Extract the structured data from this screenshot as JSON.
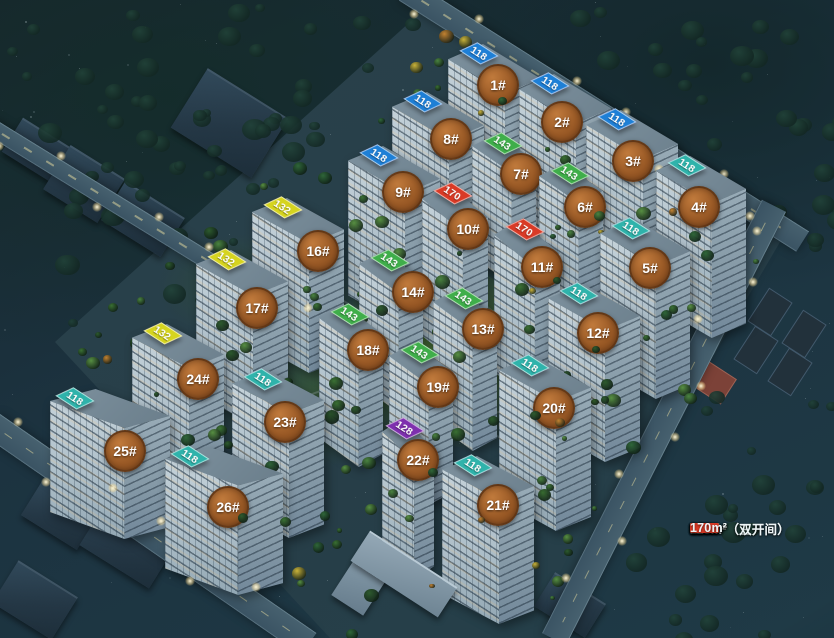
{
  "legend": {
    "items": [
      {
        "label": "89m²",
        "color": "#e8756b"
      },
      {
        "label": "106m²",
        "color": "#b93bc3"
      },
      {
        "label": "118m²（三开间）",
        "color": "#2fb3ab"
      },
      {
        "label": "118m²（双开间）",
        "color": "#1e7fd6"
      },
      {
        "label": "128m²",
        "color": "#7e2fae"
      },
      {
        "label": "132m²",
        "color": "#d6d41f"
      },
      {
        "label": "143m²",
        "color": "#3fae4a"
      },
      {
        "label": "170m²",
        "color": "#d93a26"
      }
    ]
  },
  "area_colors": {
    "89": "#e8756b",
    "106": "#b93bc3",
    "118_3": "#2fb3ab",
    "118_2": "#1e7fd6",
    "128": "#7e2fae",
    "132": "#d6d41f",
    "143": "#3fae4a",
    "170": "#d93a26"
  },
  "buildings": [
    {
      "label": "1#",
      "tx": 474,
      "ty": 40,
      "cx": 498,
      "cy": 85,
      "w": 92,
      "h": 190,
      "tags": [
        {
          "value": "118",
          "area": "118_3"
        },
        {
          "value": "106",
          "area": "106"
        },
        {
          "value": "106",
          "area": "106"
        },
        {
          "value": "118",
          "area": "118_2"
        }
      ]
    },
    {
      "label": "2#",
      "tx": 545,
      "ty": 70,
      "cx": 562,
      "cy": 122,
      "w": 92,
      "h": 190,
      "tags": [
        {
          "value": "128",
          "area": "128"
        },
        {
          "value": "106",
          "area": "106"
        },
        {
          "value": "106",
          "area": "106"
        },
        {
          "value": "118",
          "area": "118_2"
        }
      ]
    },
    {
      "label": "3#",
      "tx": 612,
      "ty": 106,
      "cx": 633,
      "cy": 161,
      "w": 92,
      "h": 188,
      "tags": [
        {
          "value": "128",
          "area": "128"
        },
        {
          "value": "106",
          "area": "106"
        },
        {
          "value": "106",
          "area": "106"
        },
        {
          "value": "118",
          "area": "118_2"
        }
      ]
    },
    {
      "label": "4#",
      "tx": 682,
      "ty": 152,
      "cx": 699,
      "cy": 207,
      "w": 90,
      "h": 182,
      "tags": [
        {
          "value": "118",
          "area": "118_2"
        },
        {
          "value": "106",
          "area": "106"
        },
        {
          "value": "106",
          "area": "106"
        },
        {
          "value": "118",
          "area": "118_3"
        }
      ]
    },
    {
      "label": "5#",
      "tx": 626,
      "ty": 215,
      "cx": 650,
      "cy": 268,
      "w": 90,
      "h": 180,
      "tags": [
        {
          "value": "118",
          "area": "118_2"
        },
        {
          "value": "106",
          "area": "106"
        },
        {
          "value": "106",
          "area": "106"
        },
        {
          "value": "118",
          "area": "118_3"
        }
      ]
    },
    {
      "label": "6#",
      "tx": 565,
      "ty": 160,
      "cx": 585,
      "cy": 207,
      "w": 64,
      "h": 150,
      "tags": [
        {
          "value": "143",
          "area": "143"
        },
        {
          "value": "143",
          "area": "143"
        }
      ]
    },
    {
      "label": "7#",
      "tx": 498,
      "ty": 130,
      "cx": 521,
      "cy": 174,
      "w": 64,
      "h": 150,
      "tags": [
        {
          "value": "143",
          "area": "143"
        },
        {
          "value": "143",
          "area": "143"
        }
      ]
    },
    {
      "label": "8#",
      "tx": 418,
      "ty": 88,
      "cx": 451,
      "cy": 139,
      "w": 92,
      "h": 185,
      "tags": [
        {
          "value": "118",
          "area": "118_3"
        },
        {
          "value": "106",
          "area": "106"
        },
        {
          "value": "106",
          "area": "106"
        },
        {
          "value": "118",
          "area": "118_2"
        }
      ]
    },
    {
      "label": "9#",
      "tx": 374,
      "ty": 142,
      "cx": 403,
      "cy": 192,
      "w": 92,
      "h": 182,
      "tags": [
        {
          "value": "118",
          "area": "118_2"
        },
        {
          "value": "106",
          "area": "106"
        },
        {
          "value": "106",
          "area": "106"
        },
        {
          "value": "118",
          "area": "118_2"
        }
      ]
    },
    {
      "label": "10#",
      "tx": 448,
      "ty": 180,
      "cx": 468,
      "cy": 229,
      "w": 66,
      "h": 185,
      "tags": [
        {
          "value": "170",
          "area": "170"
        },
        {
          "value": "170",
          "area": "170"
        }
      ]
    },
    {
      "label": "11#",
      "tx": 520,
      "ty": 216,
      "cx": 542,
      "cy": 267,
      "w": 66,
      "h": 185,
      "tags": [
        {
          "value": "170",
          "area": "170"
        },
        {
          "value": "170",
          "area": "170"
        }
      ]
    },
    {
      "label": "12#",
      "tx": 574,
      "ty": 280,
      "cx": 598,
      "cy": 333,
      "w": 92,
      "h": 178,
      "tags": [
        {
          "value": "128",
          "area": "128"
        },
        {
          "value": "106",
          "area": "106"
        },
        {
          "value": "106",
          "area": "106"
        },
        {
          "value": "118",
          "area": "118_3"
        }
      ]
    },
    {
      "label": "13#",
      "tx": 459,
      "ty": 285,
      "cx": 483,
      "cy": 329,
      "w": 64,
      "h": 162,
      "tags": [
        {
          "value": "143",
          "area": "143"
        },
        {
          "value": "143",
          "area": "143"
        }
      ]
    },
    {
      "label": "14#",
      "tx": 385,
      "ty": 247,
      "cx": 413,
      "cy": 292,
      "w": 64,
      "h": 162,
      "tags": [
        {
          "value": "143",
          "area": "143"
        },
        {
          "value": "143",
          "area": "143"
        }
      ]
    },
    {
      "label": "16#",
      "tx": 278,
      "ty": 194,
      "cx": 318,
      "cy": 251,
      "w": 92,
      "h": 175,
      "tags": [
        {
          "value": "132",
          "area": "132"
        },
        {
          "value": "128",
          "area": "128"
        },
        {
          "value": "128",
          "area": "128"
        },
        {
          "value": "132",
          "area": "132"
        }
      ]
    },
    {
      "label": "17#",
      "tx": 222,
      "ty": 246,
      "cx": 257,
      "cy": 308,
      "w": 92,
      "h": 175,
      "tags": [
        {
          "value": "132",
          "area": "132"
        },
        {
          "value": "128",
          "area": "128"
        },
        {
          "value": "128",
          "area": "128"
        },
        {
          "value": "132",
          "area": "132"
        }
      ]
    },
    {
      "label": "18#",
      "tx": 345,
      "ty": 301,
      "cx": 368,
      "cy": 350,
      "w": 64,
      "h": 162,
      "tags": [
        {
          "value": "143",
          "area": "143"
        },
        {
          "value": "143",
          "area": "143"
        }
      ]
    },
    {
      "label": "19#",
      "tx": 415,
      "ty": 339,
      "cx": 438,
      "cy": 387,
      "w": 64,
      "h": 162,
      "tags": [
        {
          "value": "143",
          "area": "143"
        },
        {
          "value": "143",
          "area": "143"
        }
      ]
    },
    {
      "label": "20#",
      "tx": 525,
      "ty": 352,
      "cx": 554,
      "cy": 408,
      "w": 92,
      "h": 175,
      "tags": [
        {
          "value": "128",
          "area": "128"
        },
        {
          "value": "106",
          "area": "106"
        },
        {
          "value": "106",
          "area": "106"
        },
        {
          "value": "118",
          "area": "118_3"
        }
      ]
    },
    {
      "label": "21#",
      "tx": 468,
      "ty": 452,
      "cx": 498,
      "cy": 505,
      "w": 92,
      "h": 168,
      "tags": [
        {
          "value": "128",
          "area": "128"
        },
        {
          "value": "106",
          "area": "106"
        },
        {
          "value": "106",
          "area": "106"
        },
        {
          "value": "118",
          "area": "118_3"
        }
      ]
    },
    {
      "label": "22#",
      "tx": 400,
      "ty": 415,
      "cx": 418,
      "cy": 460,
      "w": 52,
      "h": 160,
      "tags": [
        {
          "value": "132",
          "area": "132"
        },
        {
          "value": "128",
          "area": "128"
        }
      ]
    },
    {
      "label": "23#",
      "tx": 258,
      "ty": 366,
      "cx": 285,
      "cy": 422,
      "w": 92,
      "h": 168,
      "tags": [
        {
          "value": "118",
          "area": "118_3"
        },
        {
          "value": "106",
          "area": "106"
        },
        {
          "value": "106",
          "area": "106"
        },
        {
          "value": "118",
          "area": "118_3"
        }
      ]
    },
    {
      "label": "24#",
      "tx": 158,
      "ty": 320,
      "cx": 198,
      "cy": 379,
      "w": 92,
      "h": 170,
      "tags": [
        {
          "value": "132",
          "area": "132"
        },
        {
          "value": "128",
          "area": "128"
        },
        {
          "value": "128",
          "area": "128"
        },
        {
          "value": "132",
          "area": "132"
        }
      ]
    },
    {
      "label": "25#",
      "tx": 70,
      "ty": 385,
      "cx": 125,
      "cy": 451,
      "w": 120,
      "h": 150,
      "tags": [
        {
          "value": "118",
          "area": "118_3"
        },
        {
          "value": "89",
          "area": "89"
        },
        {
          "value": "89",
          "area": "89"
        },
        {
          "value": "89",
          "area": "89"
        },
        {
          "value": "118",
          "area": "118_3"
        }
      ]
    },
    {
      "label": "26#",
      "tx": 185,
      "ty": 443,
      "cx": 228,
      "cy": 507,
      "w": 118,
      "h": 148,
      "tags": [
        {
          "value": "118",
          "area": "118_3"
        },
        {
          "value": "89",
          "area": "89"
        },
        {
          "value": "89",
          "area": "89"
        },
        {
          "value": "89",
          "area": "89"
        },
        {
          "value": "118",
          "area": "118_3"
        }
      ]
    }
  ]
}
